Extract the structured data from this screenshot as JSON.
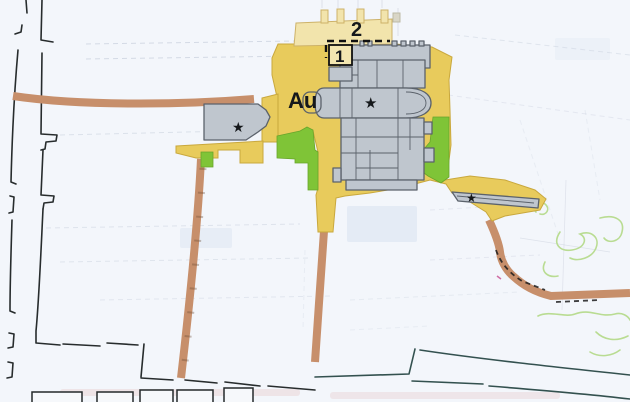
{
  "map": {
    "labels": {
      "area_code": "Au",
      "zone_1": "1",
      "zone_2": "2"
    },
    "symbols": {
      "monument_star": "★"
    },
    "colors": {
      "background": "#f3f6fb",
      "parcel_line": "#ccd3e0",
      "boundary_line": "#272c2d",
      "road_brown": "#c78f6b",
      "road_dark": "#33514f",
      "area_yellow": "#e8cb5c",
      "area_pale_yellow": "#f2e4ac",
      "area_green": "#7fc437",
      "building_fill": "#bfc6ce",
      "building_stroke": "#5b626b",
      "contour_green": "#b9dc92"
    }
  }
}
